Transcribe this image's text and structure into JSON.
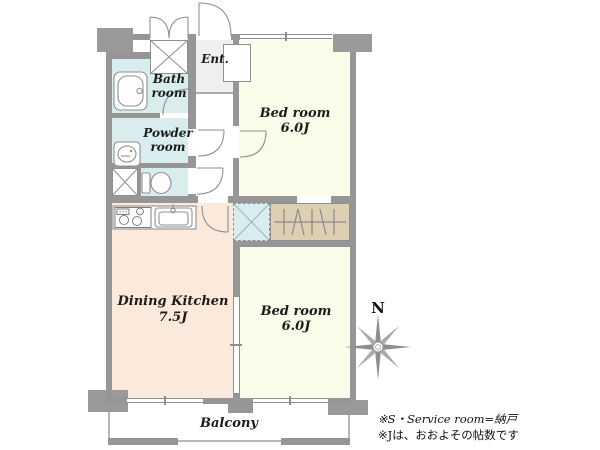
{
  "rooms": {
    "ent": {
      "name": "Ent."
    },
    "bath": {
      "line1": "Bath",
      "line2": "room"
    },
    "powder": {
      "line1": "Powder",
      "line2": "room"
    },
    "bedroom_top": {
      "line1": "Bed room",
      "line2": "6.0J"
    },
    "dining_kitchen": {
      "line1": "Dining Kitchen",
      "line2": "7.5J"
    },
    "bedroom_bottom": {
      "line1": "Bed room",
      "line2": "6.0J"
    },
    "balcony": {
      "name": "Balcony"
    }
  },
  "compass": {
    "north_label": "N"
  },
  "notes": {
    "line1": "※S・Service room=納戸",
    "line2": "※Jは、おおよその帖数です"
  },
  "colors": {
    "wall": "#969696",
    "bedroom_fill": "#fafbe8",
    "dining_kitchen_fill": "#fbe9dc",
    "wet_area_fill": "#d9edef",
    "closet_fill": "#ddcfb2",
    "balcony_border": "#b8b8b8"
  },
  "icons": {
    "bathtub-icon": "rounded rectangle tub",
    "washbasin-icon": "oval basin with tap",
    "toilet-icon": "tank and bowl",
    "washing-machine-icon": "square with X",
    "shoe-storage-icon": "rectangle with X and double-door arcs",
    "storage-x-icon": "dashed square with X",
    "hanger-closet-icon": "rod with hanger strokes",
    "stove-icon": "three burner circles",
    "kitchen-sink-icon": "inset sink with tap",
    "compass-rose-icon": "eight point star"
  }
}
